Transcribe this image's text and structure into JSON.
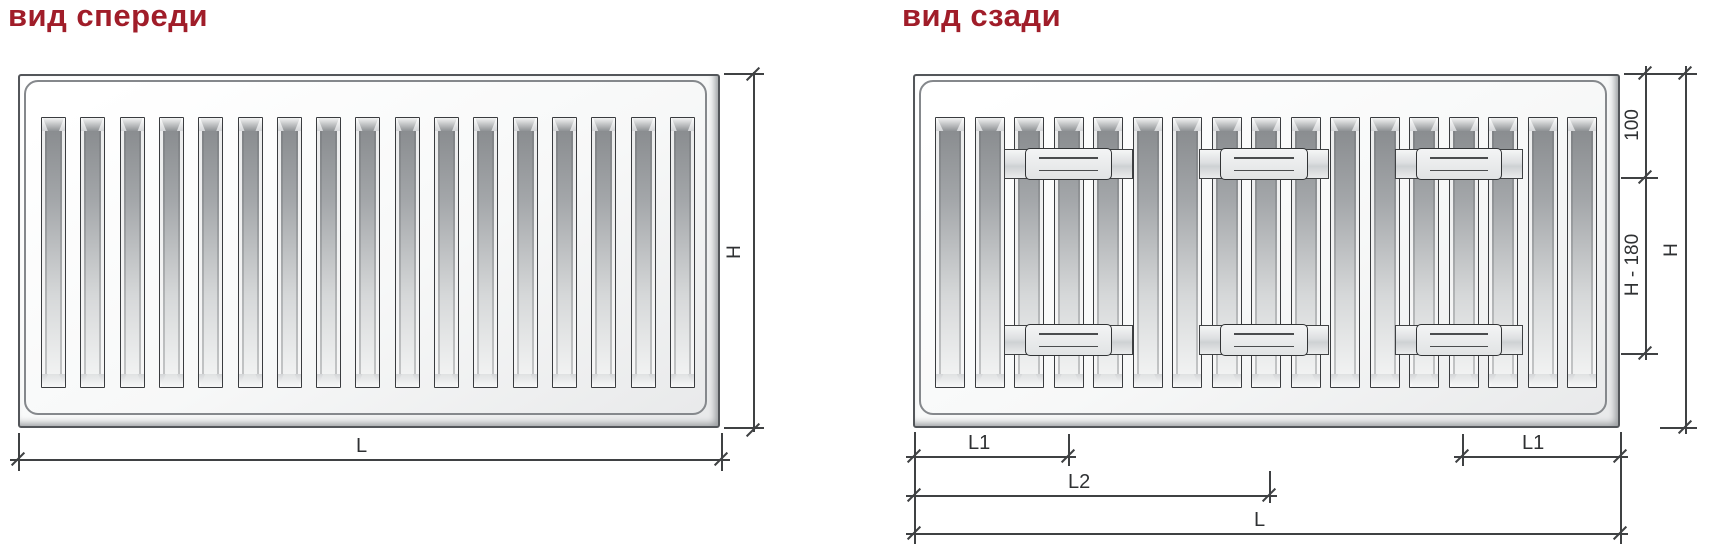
{
  "titles": {
    "front": "вид спереди",
    "rear": "вид сзади"
  },
  "front": {
    "slat_count": 17,
    "dims": {
      "length": "L",
      "height": "H"
    }
  },
  "rear": {
    "slat_count": 17,
    "bracket_columns": 3,
    "bracket_rows": 2,
    "dims": {
      "l1_left": "L1",
      "l1_right": "L1",
      "l2": "L2",
      "length": "L",
      "top_offset": "100",
      "middle": "H - 180",
      "height": "H"
    }
  },
  "colors": {
    "title": "#A01D29",
    "line": "#3F4143",
    "panel_border": "#53565A"
  }
}
